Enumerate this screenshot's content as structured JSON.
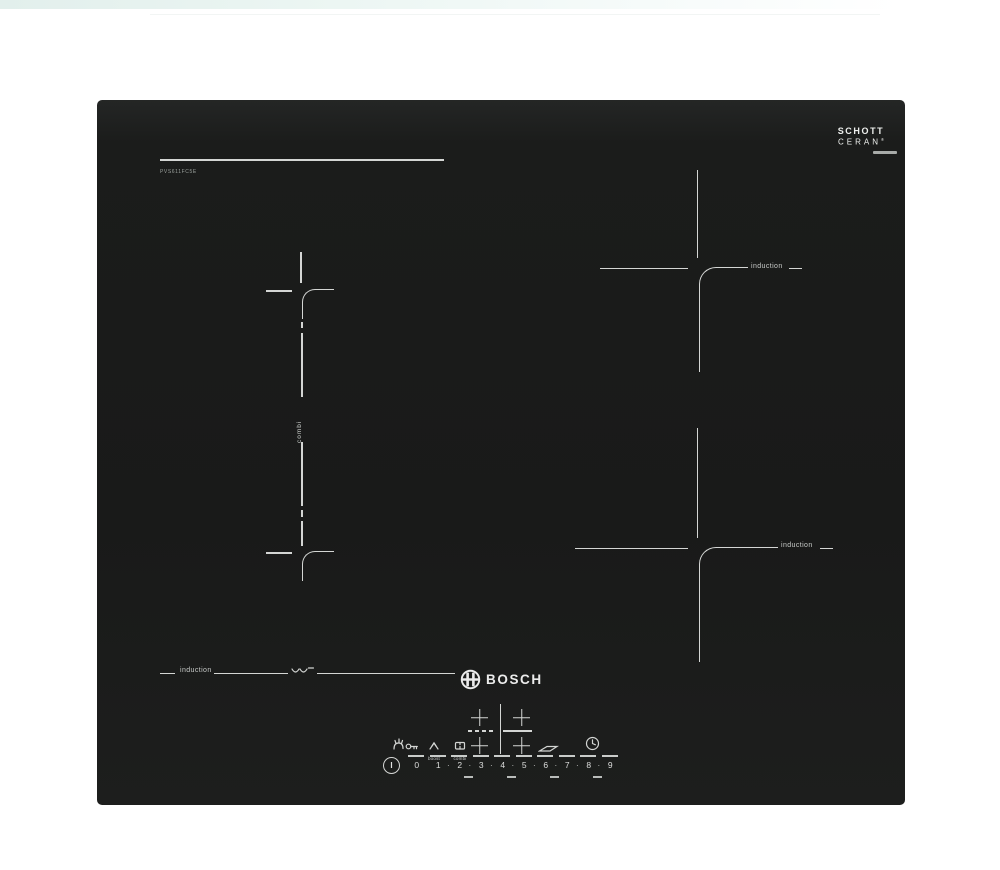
{
  "branding": {
    "model": "PVS611FC5E",
    "schott_line1": "SCHOTT",
    "schott_line2": "CERAN",
    "schott_reg": "®",
    "bosch_word": "BOSCH"
  },
  "zones": {
    "combi_label": "combi",
    "induction_top_right": "induction",
    "induction_bottom_right": "induction",
    "induction_bottom_left": "induction"
  },
  "controls": {
    "boost_label": "boost",
    "combi_key_label": "combi",
    "power_symbol": "I",
    "separator": "·",
    "levels": [
      "0",
      "1",
      "2",
      "3",
      "4",
      "5",
      "6",
      "7",
      "8",
      "9"
    ]
  },
  "colors": {
    "panel": "#1b1c1b",
    "marking": "#d4d6d4",
    "background": "#ffffff"
  }
}
